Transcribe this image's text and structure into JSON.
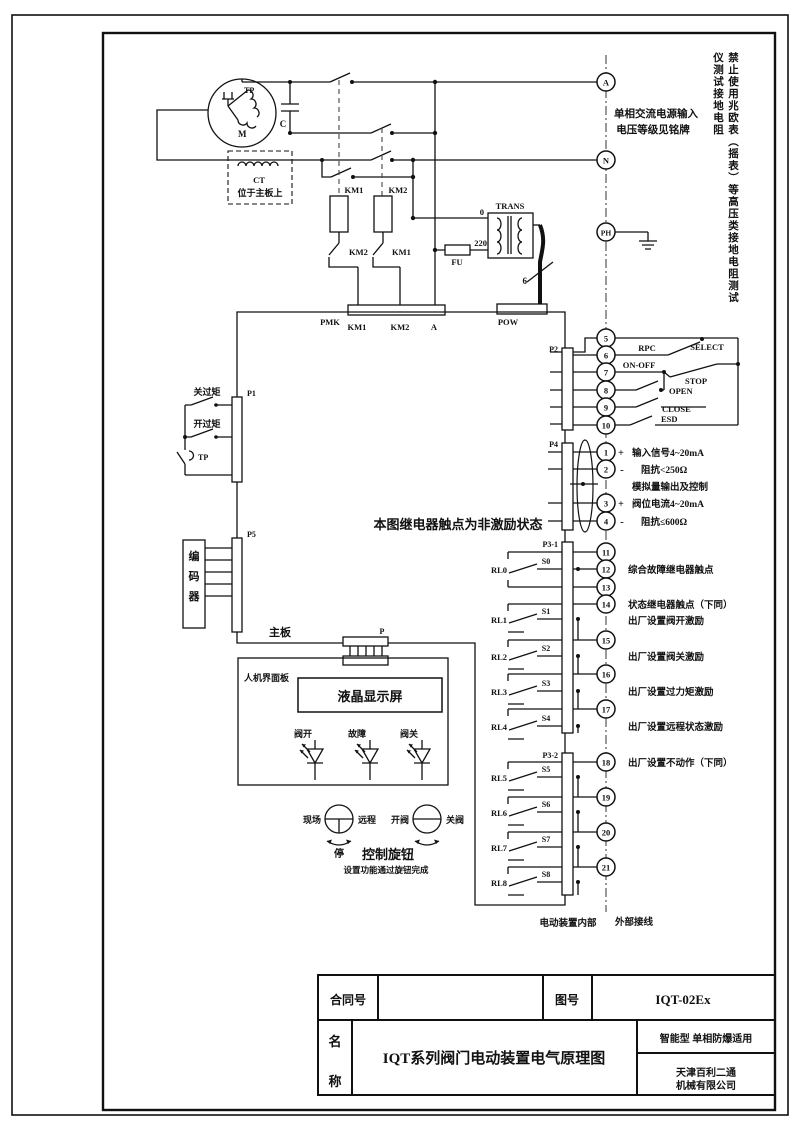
{
  "motor": {
    "tp": "TP",
    "m": "M",
    "cap": "C"
  },
  "ct": {
    "name": "CT",
    "location": "位于主板上"
  },
  "contactors": {
    "km1": "KM1",
    "km2": "KM2",
    "km1_interlock": "KM2",
    "km2_interlock": "KM1"
  },
  "power": {
    "trans": "TRANS",
    "tap0": "0",
    "tap220": "220",
    "fuse": "FU",
    "cable": "6",
    "note1": "单相交流电源输入",
    "note2": "电压等级见铭牌",
    "warning": "禁止使用兆欧表（摇表）等高压类接地电阻测试仪测试接地电阻"
  },
  "terminals": {
    "a": "A",
    "n": "N",
    "ph": "PH"
  },
  "connectors": {
    "pmk": {
      "label": "PMK",
      "pins": [
        "KM1",
        "KM2",
        "A"
      ]
    },
    "pow": "POW",
    "p1": "P1",
    "p5": "P5",
    "p": "P",
    "p2": "P2",
    "p4": "P4",
    "p31": "P3-1",
    "p32": "P3-2"
  },
  "p1_circuit": {
    "close_torque": "关过矩",
    "open_torque": "开过矩",
    "tp": "TP"
  },
  "encoder": {
    "chars": [
      "编",
      "码",
      "器"
    ]
  },
  "board": {
    "label": "主板",
    "relay_note": "本图继电器触点为非激励状态"
  },
  "hmi": {
    "panel": "人机界面板",
    "lcd": "液晶显示屏",
    "leds": [
      "阀开",
      "故障",
      "阀关"
    ],
    "knob1": {
      "left": "现场",
      "right": "远程",
      "below": "停"
    },
    "knob2": {
      "left": "开阀",
      "right": "关阀"
    },
    "knob_title": "控制旋钮",
    "knob_note": "设置功能通过旋钮完成"
  },
  "p2_circuit": {
    "terminals": [
      "5",
      "6",
      "7",
      "8",
      "9",
      "10"
    ],
    "select": "SELECT",
    "rpc": "RPC",
    "onoff": "ON-OFF",
    "stop": "STOP",
    "open": "OPEN",
    "close": "CLOSE",
    "esd": "ESD"
  },
  "p4_circuit": {
    "terminals": [
      "1",
      "2",
      "3",
      "4"
    ],
    "plus": "+",
    "minus": "-",
    "lines": [
      "输入信号4~20mA",
      "阻抗<250Ω",
      "模拟量输出及控制",
      "阀位电流4~20mA",
      "阻抗≤600Ω"
    ]
  },
  "relays": {
    "names": [
      "RL0",
      "RL1",
      "RL2",
      "RL3",
      "RL4",
      "RL5",
      "RL6",
      "RL7",
      "RL8"
    ],
    "switches": [
      "S0",
      "S1",
      "S2",
      "S3",
      "S4",
      "S5",
      "S6",
      "S7",
      "S8"
    ],
    "t31": [
      "11",
      "12",
      "13",
      "14",
      "15",
      "16",
      "17"
    ],
    "t32": [
      "18",
      "19",
      "20",
      "21"
    ],
    "notes": {
      "fault": "综合故障继电器触点",
      "status": "状态继电器触点（下同）",
      "open_exc": "出厂设置阀开激励",
      "close_exc": "出厂设置阀关激励",
      "torque_exc": "出厂设置过力矩激励",
      "remote_exc": "出厂设置远程状态激励",
      "no_action": "出厂设置不动作（下同）"
    }
  },
  "zones": {
    "internal": "电动装置内部",
    "external": "外部接线"
  },
  "titleblock": {
    "contract_label": "合同号",
    "contract_value": "",
    "drawing_label": "图号",
    "drawing_no": "IQT-02Ex",
    "name_char1": "名",
    "name_char2": "称",
    "title": "IQT系列阀门电动装置电气原理图",
    "type_note": "智能型  单相防爆适用",
    "company_line1": "天津百利二通",
    "company_line2": "机械有限公司"
  }
}
